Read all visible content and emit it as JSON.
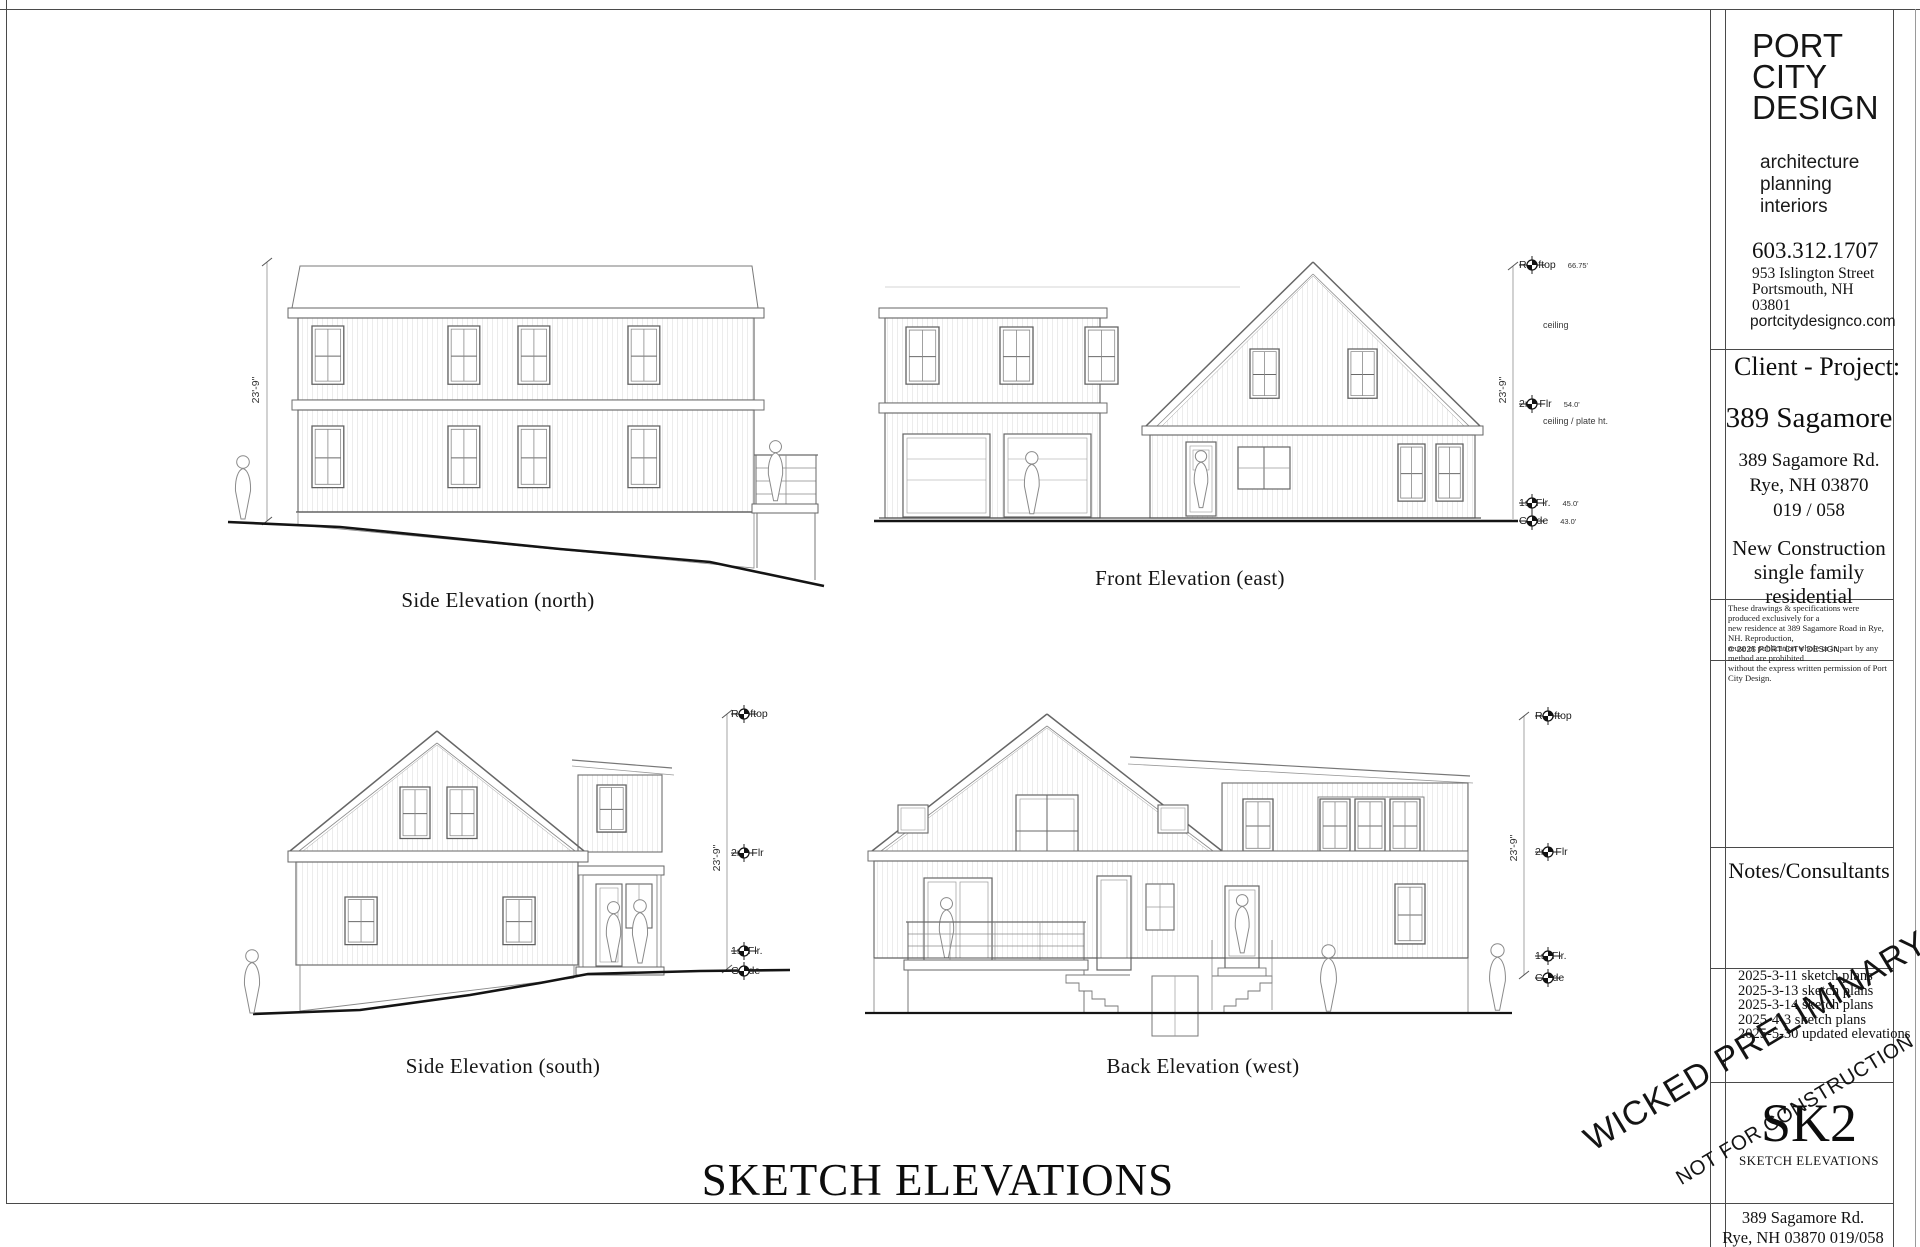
{
  "sheet": {
    "main_title": "SKETCH ELEVATIONS"
  },
  "captions": {
    "north": "Side Elevation (north)",
    "east": "Front Elevation (east)",
    "south": "Side Elevation (south)",
    "west": "Back Elevation (west)"
  },
  "stamp": {
    "line1": "WICKED PRELIMINARY",
    "line2": "NOT FOR CONSTRUCTION"
  },
  "annotations": {
    "north": {
      "dim": "23'-9\""
    },
    "east": {
      "dim": "23'-9\"",
      "ceiling_note": "ceiling",
      "plate_note": "ceiling / plate ht.",
      "levels": [
        {
          "label": "Rooftop",
          "value": "66.75'"
        },
        {
          "label": "2nd Flr",
          "value": "54.0'"
        },
        {
          "label": "1st Flr.",
          "value": "45.0'"
        },
        {
          "label": "Grade",
          "value": "43.0'"
        }
      ]
    },
    "south": {
      "dim": "23'-9\"",
      "levels": [
        {
          "label": "Rooftop"
        },
        {
          "label": "2nd Flr"
        },
        {
          "label": "1st Flr."
        },
        {
          "label": "Grade"
        }
      ]
    },
    "west": {
      "dim": "23'-9\"",
      "levels": [
        {
          "label": "Rooftop"
        },
        {
          "label": "2nd Flr"
        },
        {
          "label": "1st Flr."
        },
        {
          "label": "Grade"
        }
      ]
    }
  },
  "title_block": {
    "firm": {
      "name_lines": [
        "PORT",
        "CITY",
        "DESIGN"
      ],
      "services": [
        "architecture",
        "planning",
        "interiors"
      ],
      "phone": "603.312.1707",
      "address": [
        "953 Islington Street",
        "Portsmouth, NH",
        "03801"
      ],
      "website": "portcitydesignco.com"
    },
    "client_project": {
      "heading": "Client - Project:",
      "project_name": "389 Sagamore",
      "address": [
        "389 Sagamore Rd.",
        "Rye, NH  03870",
        "019 / 058"
      ],
      "description": [
        "New Construction",
        "single family",
        "residential"
      ]
    },
    "disclaimer": [
      "These drawings & specifications were produced exclusively for a",
      "new residence at 389 Sagamore Road in Rye, NH.  Reproduction,",
      "reuse or publication whole or in part by any method are prohibited",
      "without the express written permission of Port City Design."
    ],
    "copyright": "© 2025  PORT CITY DESIGN",
    "notes_heading": "Notes/Consultants",
    "revisions": [
      "2025-3-11 sketch plans",
      "2025-3-13 sketch plans",
      "2025-3-14 sketch plans",
      "2025-4-3 sketch plans",
      "2025-5-30 updated elevations"
    ],
    "sheet_number": "SK2",
    "sheet_name": "SKETCH ELEVATIONS",
    "footer": [
      "389 Sagamore Rd.",
      "Rye, NH  03870  019/058"
    ]
  }
}
